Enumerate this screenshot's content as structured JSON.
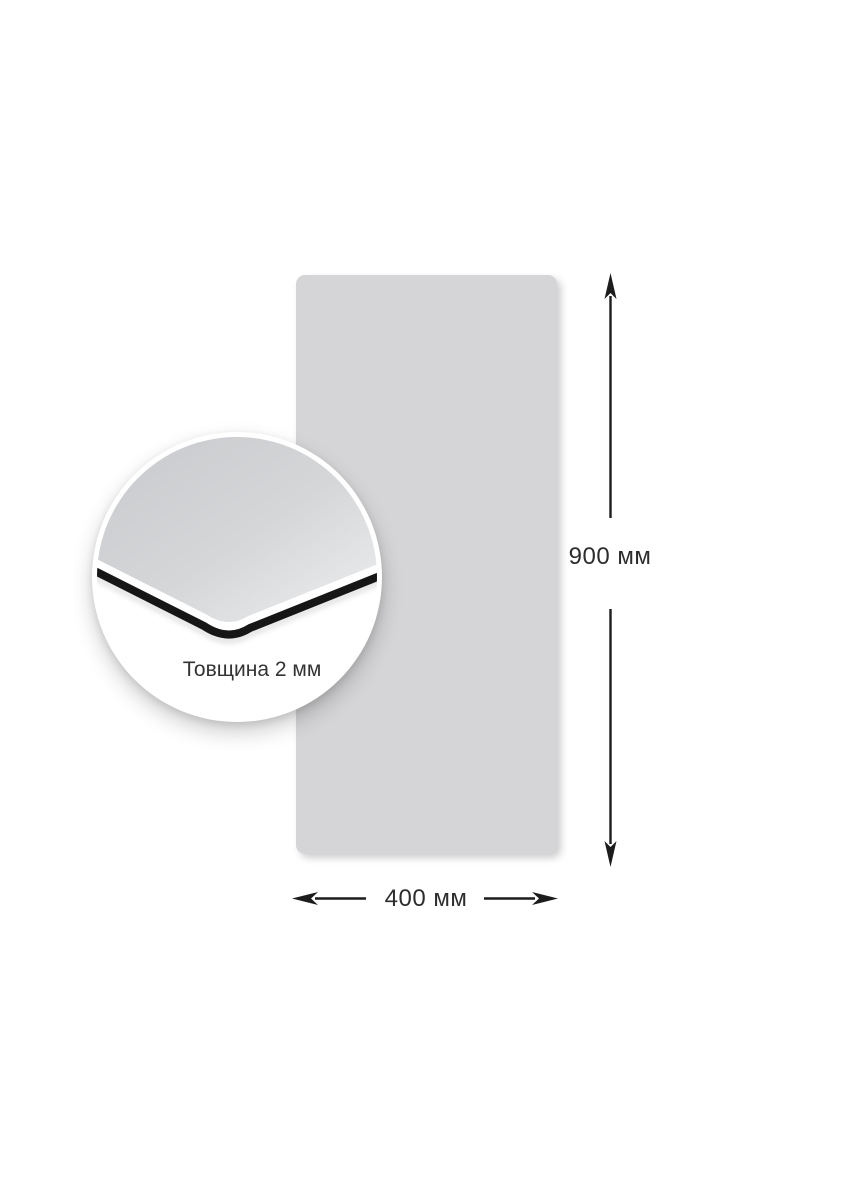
{
  "page": {
    "background_color": "#ffffff"
  },
  "product": {
    "type": "flat-rectangular-panel",
    "panel_color": "#d5d4d6",
    "edge_color": "#161616",
    "inset_surface_gradient": [
      "#c6c8cb",
      "#d5d6d8",
      "#e9eaeb"
    ]
  },
  "annotations": {
    "line_color": "#1c1c1c",
    "label_color": "#2d2d2d",
    "height": {
      "label": "900 мм",
      "value": 900,
      "unit": "мм"
    },
    "width": {
      "label": "400 мм",
      "value": 400,
      "unit": "мм"
    },
    "thickness": {
      "label": "Товщина 2 мм",
      "value": 2,
      "unit": "мм"
    }
  }
}
